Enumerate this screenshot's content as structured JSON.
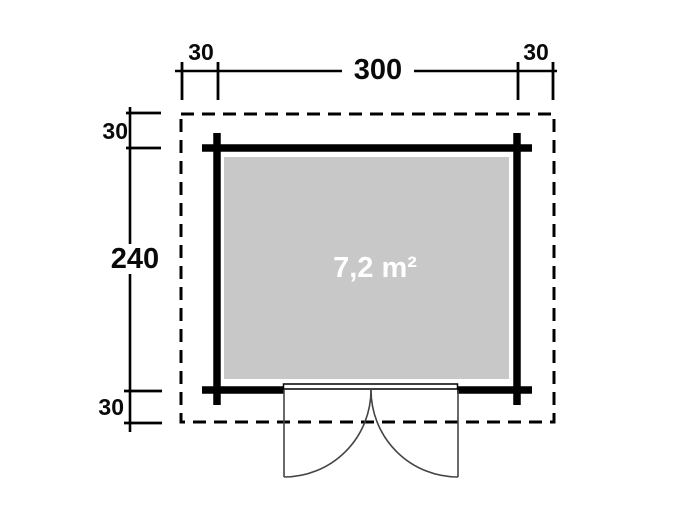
{
  "diagram": {
    "area_label": "7,2 m²",
    "dim_top": {
      "left_overhang": "30",
      "width": "300",
      "right_overhang": "30"
    },
    "dim_left": {
      "top_overhang": "30",
      "depth": "240",
      "bottom_overhang": "30"
    },
    "colors": {
      "line": "#000000",
      "floor_fill": "#c8c8c8",
      "area_text": "#ffffff",
      "door_line": "#444444",
      "background": "#ffffff"
    }
  }
}
